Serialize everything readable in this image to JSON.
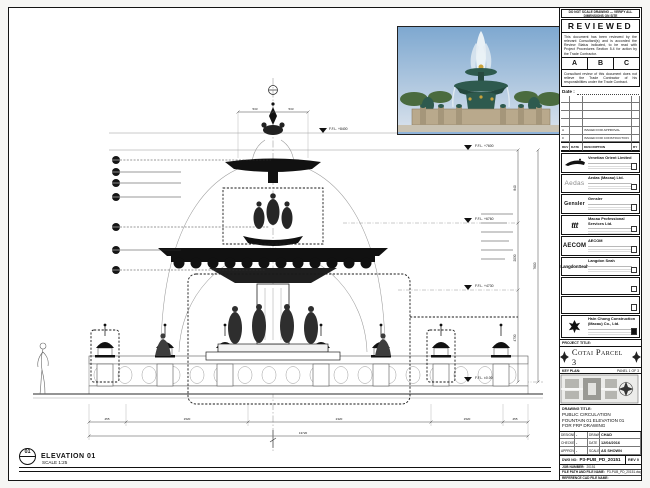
{
  "colors": {
    "paper": "#ffffff",
    "ink": "#111111",
    "photo_sky": "#8fb3d9",
    "photo_bronze": "#2e5a4e",
    "photo_stone": "#b9a98c"
  },
  "drawing": {
    "elevation_tag": {
      "number": "01",
      "title": "ELEVATION 01",
      "scale": "SCALE 1:25"
    },
    "levels": [
      {
        "label": "F.F.L. +8400"
      },
      {
        "label": "F.F.L. +7600"
      },
      {
        "label": "F.F.L. +6760"
      },
      {
        "label": "F.F.L. +4730"
      },
      {
        "label": "F.F.L. ±0.00"
      }
    ],
    "vdims": [
      "840",
      "2030",
      "4730"
    ],
    "overall_height": "7600",
    "topdims": [
      "533",
      "533"
    ],
    "botdims": [
      "455",
      "1520",
      "2320",
      "1520",
      "455"
    ],
    "overall_width": "13720"
  },
  "titleblock": {
    "note": "DO NOT SCALE DRAWING — VERIFY ALL DIMENSIONS ON SITE",
    "stamp": {
      "title": "REVIEWED",
      "body1": "This document has been reviewed by the relevant Consultant(s) and is accorded the Review Status indicated, to be read with Project Procedures Section 5.4 for action by the Trade Contractor.",
      "options": [
        "A",
        "B",
        "C"
      ],
      "body2": "Consultant review of this document does not relieve the Trade Contractor of his responsibilities under the Trade Contract.",
      "date_label": "Date :"
    },
    "revisions": {
      "headers": [
        "REV",
        "DATE",
        "DESCRIPTION",
        "BY"
      ],
      "rows": [
        {
          "rev": "A",
          "date": "",
          "desc": "ISSUED FOR APPROVAL",
          "by": ""
        },
        {
          "rev": "0",
          "date": "",
          "desc": "ISSUED FOR CONSTRUCTION",
          "by": ""
        }
      ]
    },
    "consultants": [
      {
        "logo": "gondola-mark",
        "name": "Venetian Orient Limited"
      },
      {
        "logo": "Aedas",
        "name": "Aedas (Macau) Ltd."
      },
      {
        "logo": "Gensler",
        "name": "Gensler"
      },
      {
        "logo": "ttt",
        "name": "Macau Professional Services Ltd."
      },
      {
        "logo": "AECOM",
        "name": "AECOM"
      },
      {
        "logo": "LangdonSeah",
        "name": "Langdon Seah"
      }
    ],
    "contractor": {
      "name": "Hsin Chong Construction (Macau) Co., Ltd."
    },
    "project": {
      "label": "PROJECT TITLE:",
      "name": "Cotai Parcel 3"
    },
    "key_plan": {
      "label": "KEY PLAN:",
      "panel": "PANEL 1 OF 3"
    },
    "drawing_title": {
      "label": "DRAWING TITLE:",
      "line1": "PUBLIC CIRCULATION",
      "line2": "FOUNTAIN 01 ELEVATION 01",
      "line3": "FOR FRP DRAWING"
    },
    "info": {
      "designed_label": "DESIGNED",
      "designed": "-",
      "drawn_label": "DRAWN",
      "drawn": "CHAD",
      "checked_label": "CHECKED",
      "checked": "-",
      "date_label": "DATE",
      "date": "12/04/2016",
      "approved_label": "APPROVED",
      "approved": "-",
      "scale_label": "SCALE",
      "scale": "AS SHOWN"
    },
    "dwg": {
      "label": "DWG NO:",
      "value": "P3-PUB_PD_20151",
      "rev": "REV 0"
    },
    "job": {
      "label": "JOB NUMBER:",
      "value": "20151"
    },
    "file": {
      "label": "FILE PATH AND FILE NAME:",
      "value": "P3-PUB_PD_20151.dwg"
    },
    "ref": {
      "label": "REFERENCE CAD FILE NAME:",
      "value": ""
    }
  }
}
